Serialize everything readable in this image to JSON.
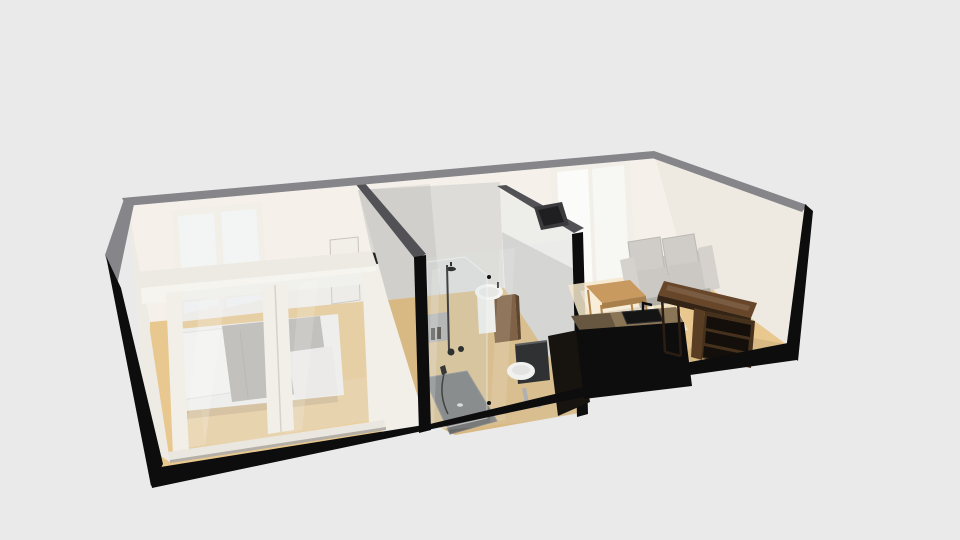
{
  "scene": {
    "title": "3D apartment floor plan model",
    "description": "Isometric dollhouse cutaway 3D render of a small apartment floor plan on a plain light gray background",
    "rooms": [
      {
        "id": "bedroom",
        "label": "Bedroom",
        "position": "left",
        "contents": [
          "double bed with white bedding, white pillow and gray duvet",
          "sliding glass partition with white frames and bottom track",
          "two-pane window on back wall",
          "tan wood floor"
        ]
      },
      {
        "id": "bathroom",
        "label": "Bathroom",
        "position": "center",
        "contents": [
          "glass-fronted wet room with black corner posts",
          "walk-in shower with black rain head, riser rail, valves and hand shower",
          "dark gray shower tray with drain",
          "wall niche with toiletry bottles",
          "round white basin on dark wood vanity",
          "toilet with white bowl, black cistern and chrome waste pipe"
        ]
      },
      {
        "id": "living-kitchen",
        "label": "Living room / kitchenette",
        "position": "right",
        "contents": [
          "light gray two-seat sofa",
          "light wood coffee table with open metal frame",
          "tall glazed balcony door",
          "kitchen counter with black base, wood worktop, black sink and faucet",
          "dark wood desk along right wall",
          "dark wood cube shelf unit",
          "dark flat panel mounted on bathroom wall"
        ]
      }
    ],
    "structure": {
      "exterior_walls": "matte black shells",
      "wall_top_edges": "gray cut edges",
      "interior_walls": "off-white",
      "floor": "tan wood",
      "entry_door": "white door on back wall between bedroom and bathroom"
    }
  },
  "palette": {
    "background": "#eaeaea",
    "wall_white": "#f5f1ea",
    "white_frame": "#f2efe8",
    "window_pane": "#f3f5f4",
    "window_pane_bright": "#fbfbf9",
    "wall_top_gray": "#85858a",
    "band_dark": "#515156",
    "exterior_black": "#0d0d0e",
    "floor_tan": "#e9c88f",
    "floor_light": "#f6e9cb",
    "bath_wall": "#dddcd8",
    "tray_gray": "#696969",
    "bed_white": "#f3f2ef",
    "bed_duvet": "#b9b6b1",
    "sofa_gray": "#cac7c2",
    "wood_light": "#c89a5f",
    "wood_medium": "#8a7557",
    "wood_dark": "#68462a",
    "fixture_black": "#161617",
    "chrome": "#a8a8aa"
  }
}
